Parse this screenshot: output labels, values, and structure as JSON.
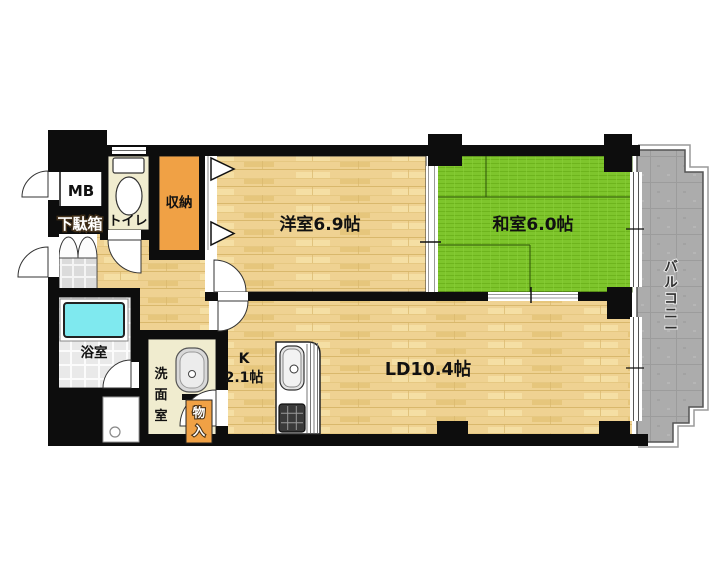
{
  "title": "apartment-floor-plan",
  "colors": {
    "wall": "#0d0d0d",
    "wood_floor": "#EFD292",
    "wood_line": "#D9B86C",
    "tatami_green": "#7EC52C",
    "closet_orange": "#F0A145",
    "service_cream": "#F0ECCF",
    "balcony_gray": "#ACACAC",
    "bathtub_cyan": "#7FE9EF",
    "bath_tile": "#E9E9E9",
    "entry_tile": "#DBDBDB"
  },
  "rooms": {
    "meter_box": {
      "label": "MB"
    },
    "shoe_cabinet": {
      "label": "下駄箱"
    },
    "toilet": {
      "label": "トイレ"
    },
    "closet": {
      "label": "収納"
    },
    "western_room": {
      "label": "洋室6.9帖"
    },
    "japanese_room": {
      "label": "和室6.0帖"
    },
    "balcony": {
      "label": "バルコニー",
      "chars": [
        "バ",
        "ル",
        "コ",
        "ニ",
        "ー"
      ]
    },
    "bathroom": {
      "label": "浴室"
    },
    "washroom": {
      "label": "洗面室",
      "chars": [
        "洗",
        "面",
        "室"
      ]
    },
    "storage": {
      "label": "物入",
      "chars": [
        "物",
        "入"
      ]
    },
    "kitchen": {
      "label_letter": "K",
      "label_size": "2.1帖"
    },
    "living_dining": {
      "label": "LD10.4帖"
    }
  }
}
